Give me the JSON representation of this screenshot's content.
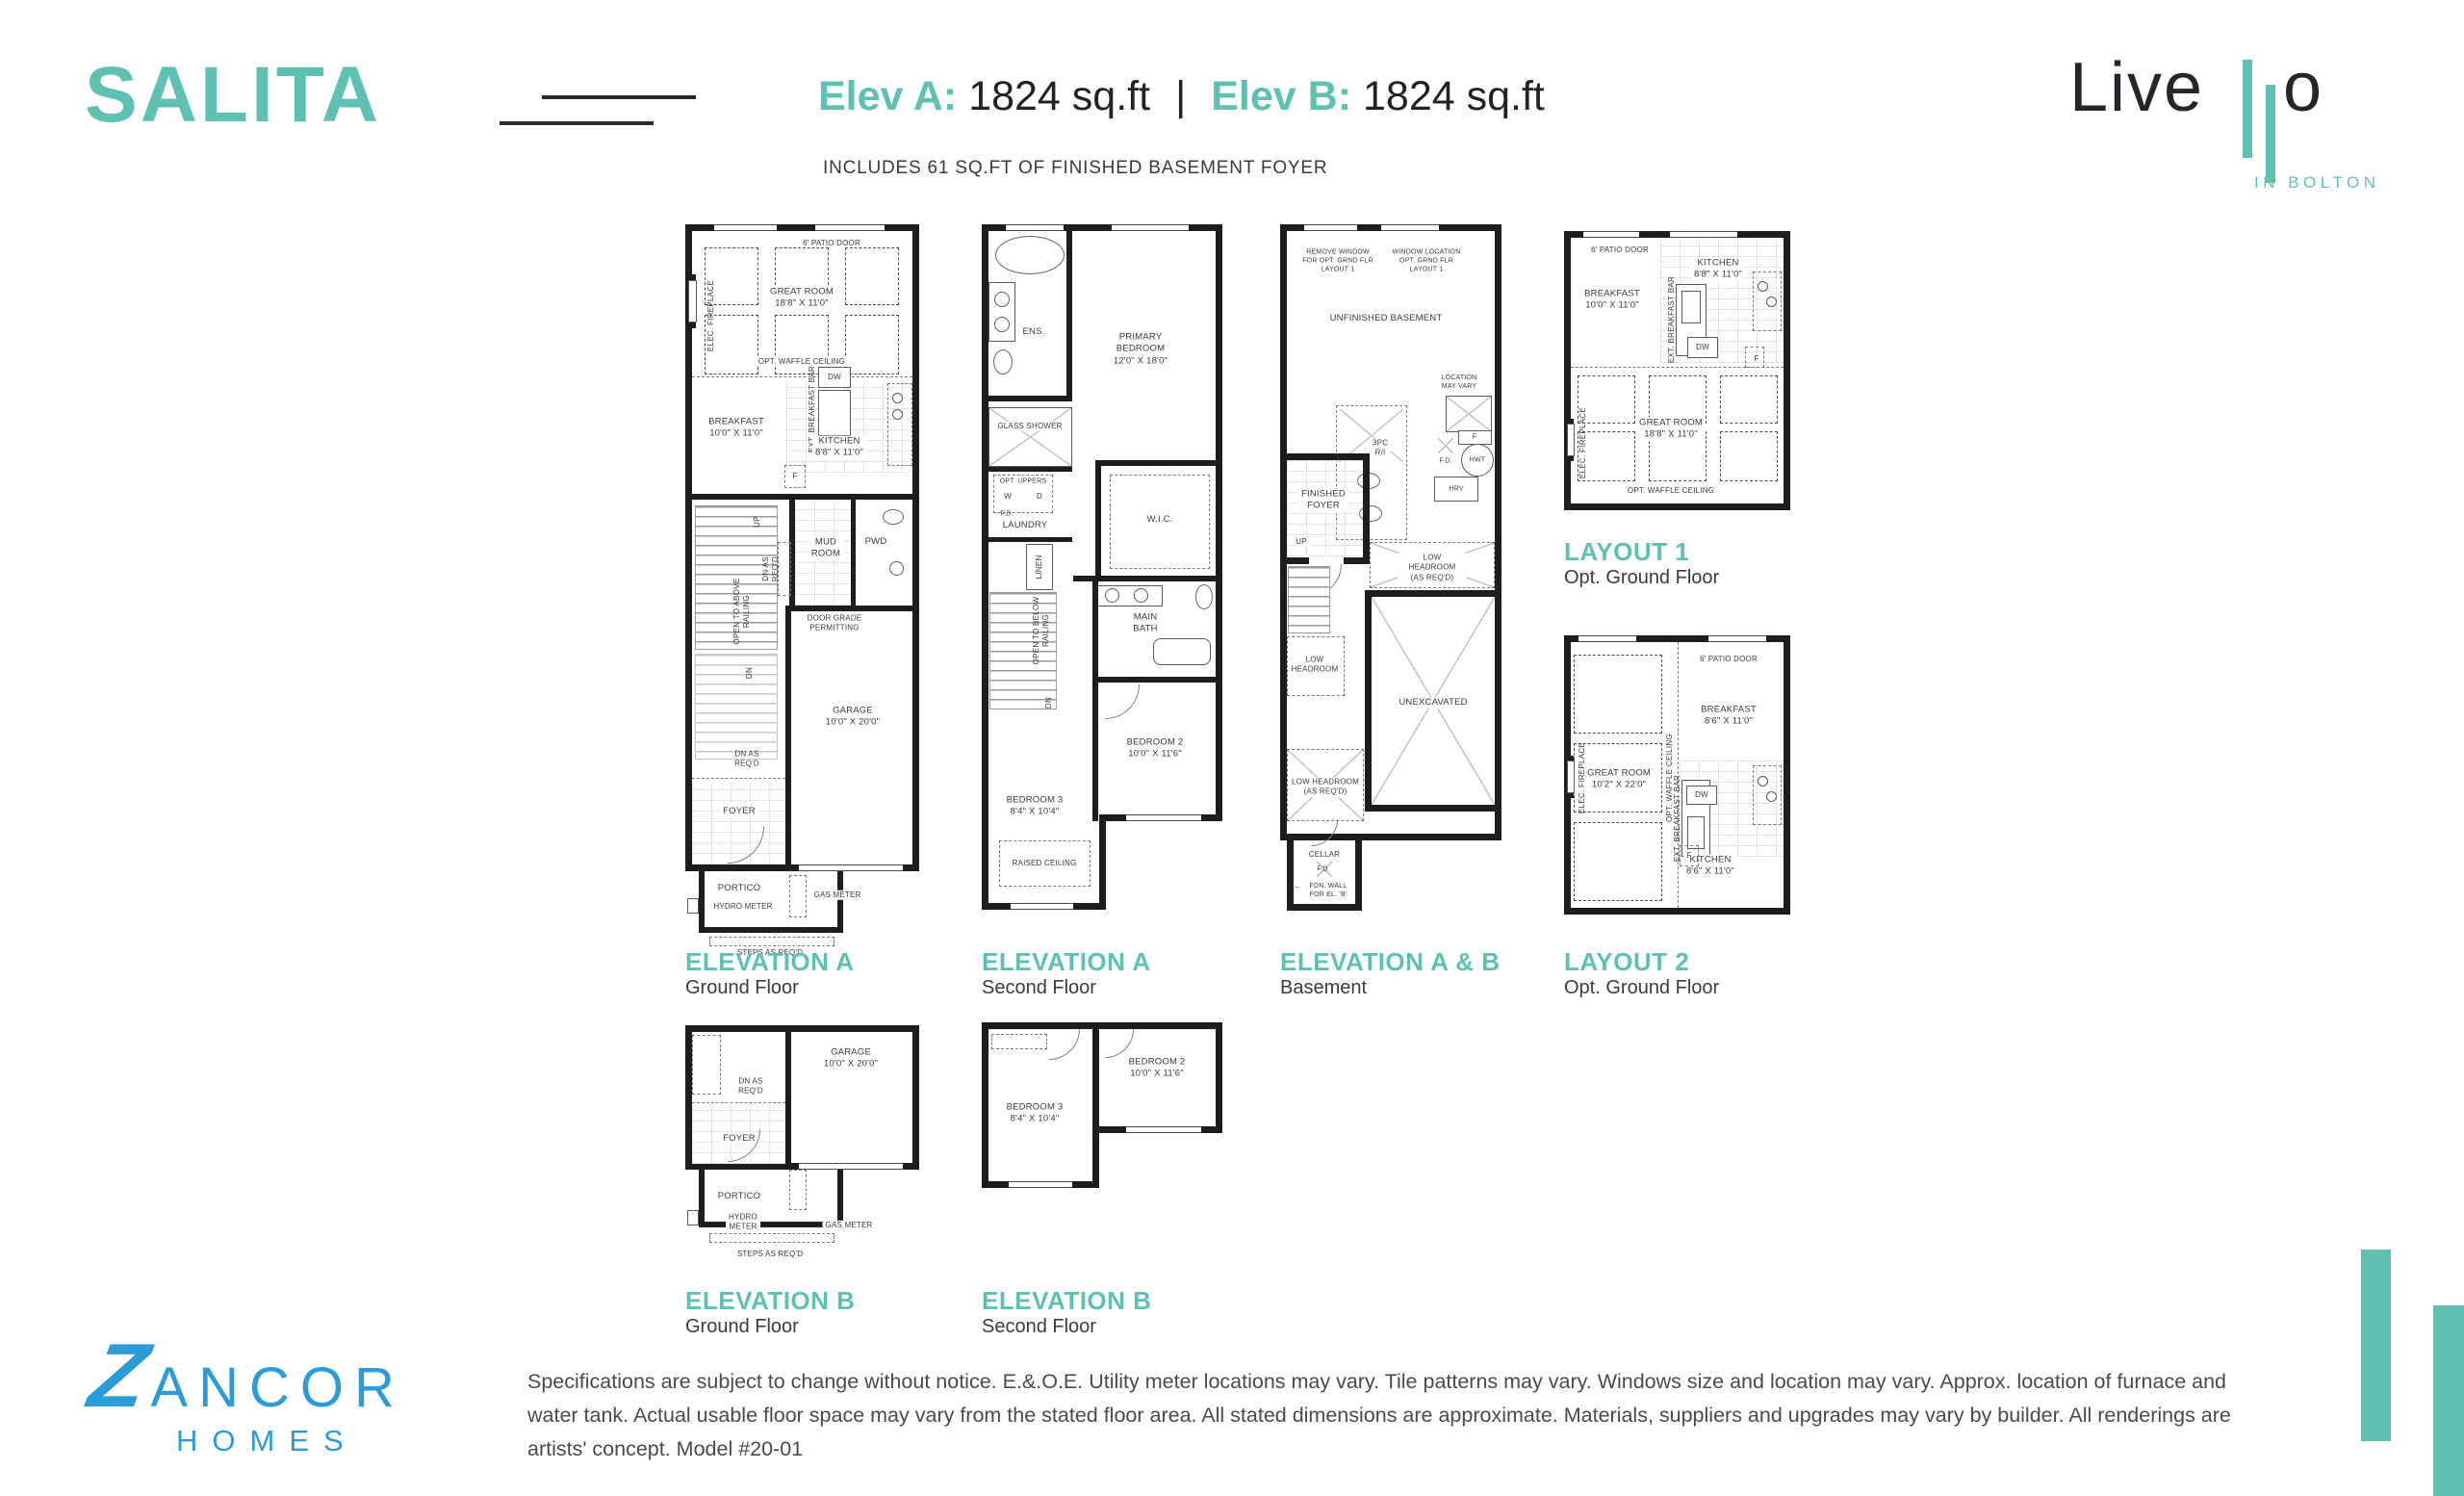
{
  "meta": {
    "accent_teal": "#5ec1b2",
    "zancor_blue": "#2c9cd9",
    "wall_black": "#1d1d1b"
  },
  "icons": {
    "left_arrow": "←"
  },
  "header": {
    "model_name": "SALITA",
    "elev_a_label": "Elev A:",
    "elev_a_value": "1824 sq.ft",
    "divider": "|",
    "elev_b_label": "Elev B:",
    "elev_b_value": "1824 sq.ft",
    "basement_note": "INCLUDES 61 SQ.FT OF FINISHED BASEMENT FOYER"
  },
  "livello_logo": {
    "word_start": "Live",
    "word_end": "o",
    "tagline": "IN BOLTON"
  },
  "zancor_logo": {
    "initial": "Z",
    "name_rest": "ANCOR",
    "sub": "HOMES"
  },
  "captions": {
    "a_ground": {
      "title": "ELEVATION A",
      "sub": "Ground Floor"
    },
    "a_second": {
      "title": "ELEVATION A",
      "sub": "Second Floor"
    },
    "ab_basement": {
      "title": "ELEVATION A & B",
      "sub": "Basement"
    },
    "layout1": {
      "title": "LAYOUT 1",
      "sub": "Opt. Ground Floor"
    },
    "layout2": {
      "title": "LAYOUT 2",
      "sub": "Opt. Ground Floor"
    },
    "b_ground": {
      "title": "ELEVATION B",
      "sub": "Ground Floor"
    },
    "b_second": {
      "title": "ELEVATION B",
      "sub": "Second Floor"
    }
  },
  "plans": {
    "a_ground": {
      "patio_door": "6' PATIO DOOR",
      "elec_fireplace": "ELEC. FIREPLACE",
      "great_room": "GREAT ROOM\n18'8\" X 11'0\"",
      "waffle_ceiling": "OPT. WAFFLE CEILING",
      "breakfast": "BREAKFAST\n10'0\" X 11'0\"",
      "dw": "DW",
      "breakfast_bar": "EXT. BREAKFAST BAR",
      "kitchen": "KITCHEN\n8'8\" X 11'0\"",
      "fridge": "F",
      "up": "UP",
      "dn_as_reqd_upper": "DN AS\nREQ'D",
      "mud_room": "MUD\nROOM",
      "pwd": "PWD",
      "door_grade": "DOOR GRADE\nPERMITTING",
      "open_to_above": "OPEN TO ABOVE\nRAILING",
      "dn": "DN",
      "garage": "GARAGE\n10'0\" X 20'0\"",
      "dn_as_reqd_lower": "DN AS\nREQ'D",
      "foyer": "FOYER",
      "portico": "PORTICO",
      "hydro_meter": "HYDRO METER",
      "gas_meter": "GAS METER",
      "steps": "STEPS AS REQ'D"
    },
    "a_second": {
      "ens": "ENS.",
      "primary_bedroom": "PRIMARY BEDROOM\n12'0\" X 18'0\"",
      "glass_shower": "GLASS SHOWER",
      "opt_uppers": "OPT. UPPERS",
      "washer": "W",
      "dryer": "D",
      "floor_drain": "F.D.",
      "laundry": "LAUNDRY",
      "linen": "LINEN",
      "wic": "W.I.C.",
      "open_to_below": "OPEN TO BELOW\nRAILING",
      "dn": "DN",
      "main_bath": "MAIN\nBATH",
      "bedroom_2": "BEDROOM 2\n10'0\" X 11'6\"",
      "bedroom_3": "BEDROOM 3\n8'4\" X 10'4\"",
      "raised_ceiling": "RAISED CEILING"
    },
    "ab_basement": {
      "remove_window": "REMOVE WINDOW\nFOR OPT. GRND FLR\nLAYOUT 1",
      "window_location": "WINDOW LOCATION\nOPT. GRND FLR\nLAYOUT 1",
      "unfinished_basement": "UNFINISHED BASEMENT",
      "location_may_vary": "LOCATION\nMAY VARY",
      "furnace": "F",
      "bath_rough_in": "3PC\nR/I",
      "floor_drain_1": "F.D.",
      "hwt": "HWT",
      "hrv": "HRV",
      "finished_foyer": "FINISHED\nFOYER",
      "up": "UP",
      "low_headroom_upper": "LOW HEADROOM\n(AS REQ'D)",
      "low_headroom_left": "LOW\nHEADROOM",
      "unexcavated": "UNEXCAVATED",
      "low_headroom_lower": "LOW HEADROOM\n(AS REQ'D)",
      "cellar": "CELLAR",
      "floor_drain_2": "F.D.",
      "fdn_wall": "FDN. WALL\nFOR EL. 'B'"
    },
    "layout1": {
      "patio_door": "6' PATIO DOOR",
      "kitchen": "KITCHEN\n8'8\" X 11'0\"",
      "breakfast": "BREAKFAST\n10'0\" X 11'0\"",
      "breakfast_bar": "EXT. BREAKFAST BAR",
      "dw": "DW",
      "fridge": "F",
      "great_room": "GREAT ROOM\n18'8\" X 11'0\"",
      "elec_fireplace": "ELEC. FIREPLACE",
      "waffle_ceiling": "OPT. WAFFLE CEILING"
    },
    "layout2": {
      "patio_door": "6' PATIO DOOR",
      "breakfast": "BREAKFAST\n8'6\" X 11'0\"",
      "great_room": "GREAT ROOM\n10'2\" X 22'0\"",
      "elec_fireplace": "ELEC. FIREPLACE",
      "waffle_ceiling": "OPT. WAFFLE CEILING",
      "breakfast_bar": "EXT. BREAKFAST BAR",
      "dw": "DW",
      "kitchen": "KITCHEN\n8'6\" X 11'0\"",
      "fridge": "F"
    },
    "b_ground": {
      "garage": "GARAGE\n10'0\" X 20'0\"",
      "dn_as_reqd": "DN AS\nREQ'D",
      "foyer": "FOYER",
      "portico": "PORTICO",
      "hydro_meter": "HYDRO\nMETER",
      "gas_meter": "GAS METER",
      "steps": "STEPS AS REQ'D"
    },
    "b_second": {
      "bedroom_2": "BEDROOM 2\n10'0\" X 11'6\"",
      "bedroom_3": "BEDROOM 3\n8'4\" X 10'4\""
    }
  },
  "footer": {
    "disclaimer": "Specifications are subject to change without notice. E.&.O.E. Utility meter locations may vary. Tile patterns may vary. Windows size and location may vary. Approx. location of furnace and water tank. Actual usable floor space may vary from the stated floor area. All stated dimensions are approximate. Materials, suppliers and upgrades may vary by builder. All renderings are artists' concept. Model #20-01"
  }
}
